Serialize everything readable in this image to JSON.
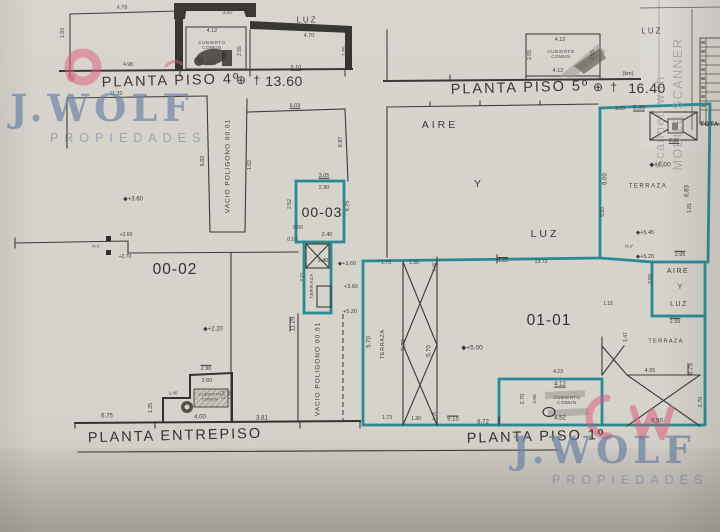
{
  "watermarks": {
    "brand": "J.WOLF",
    "sub": "PROPIEDADES",
    "scan_line1": "Scanned with",
    "scan_line2": "MOBILE SCANNER"
  },
  "plans": {
    "piso4": {
      "title": "PLANTA PISO 4º",
      "marker": "⊕ †",
      "level": "13.60"
    },
    "piso5": {
      "title": "PLANTA PISO 5º",
      "marker": "⊕ †",
      "level": "16.40"
    },
    "entrepiso": {
      "title": "PLANTA ENTREPISO"
    },
    "piso1": {
      "title": "PLANTA PISO 1º"
    }
  },
  "units": {
    "u02": "00-02",
    "u03": "00-03",
    "u11": "01-01"
  },
  "courtyard": {
    "aire": "AIRE",
    "y": "Y",
    "luz": "LUZ"
  },
  "table": {
    "total": "TOTA"
  },
  "colors": {
    "teal": "#2a8a94",
    "ink": "#3c3a34",
    "brand_blue": "#6d84a6",
    "pink": "#d95573",
    "paper": "#d6d3cc"
  },
  "labels": [
    {
      "t": "4.78",
      "x": 122,
      "y": 8,
      "r": -3,
      "s": 5.5
    },
    {
      "t": "1.93",
      "x": 64,
      "y": 33,
      "r": -90,
      "s": 5
    },
    {
      "t": "3.87",
      "x": 228,
      "y": 13,
      "r": -2,
      "s": 5.5
    },
    {
      "t": "4.12",
      "x": 212,
      "y": 31,
      "s": 5.5
    },
    {
      "t": "CUBIERTO COMUN",
      "x": 212,
      "y": 45,
      "wd": 34,
      "s": 4.5,
      "w": 0.5
    },
    {
      "t": "4.12",
      "x": 211,
      "y": 64,
      "s": 5.5
    },
    {
      "t": "2.55",
      "x": 182,
      "y": 51,
      "r": -90,
      "s": 5
    },
    {
      "t": "2.55",
      "x": 241,
      "y": 51,
      "r": -90,
      "s": 5
    },
    {
      "t": "4.98",
      "x": 128,
      "y": 66,
      "s": 5
    },
    {
      "t": "4.70",
      "x": 309,
      "y": 36,
      "s": 5.5
    },
    {
      "t": "6.10",
      "x": 296,
      "y": 68,
      "u": 1,
      "s": 5.5
    },
    {
      "t": "1.85",
      "x": 346,
      "y": 51,
      "r": -90,
      "s": 5
    },
    {
      "t": "LUZ",
      "x": 307,
      "y": 20,
      "s": 8,
      "w": 2
    },
    {
      "t": "4.12",
      "x": 560,
      "y": 40,
      "s": 5.5
    },
    {
      "t": "CUBIERTO COMUN",
      "x": 561,
      "y": 54,
      "wd": 34,
      "s": 4.5,
      "w": 0.5
    },
    {
      "t": "4.12",
      "x": 558,
      "y": 71,
      "s": 5.5
    },
    {
      "t": "2.55",
      "x": 531,
      "y": 55,
      "r": -90,
      "s": 5
    },
    {
      "t": "2.55",
      "x": 594,
      "y": 55,
      "r": -90,
      "s": 5
    },
    {
      "t": "LUZ",
      "x": 652,
      "y": 31,
      "s": 8,
      "w": 2
    },
    {
      "t": "(km)",
      "x": 628,
      "y": 74,
      "s": 5.5
    },
    {
      "t": "11.32",
      "x": 116,
      "y": 94,
      "s": 5.5
    },
    {
      "t": "6.03",
      "x": 295,
      "y": 106,
      "u": 1,
      "s": 5.5
    },
    {
      "t": "VACIO POLIGONO 00.01",
      "x": 228,
      "y": 166,
      "r": -90,
      "s": 6.5,
      "w": 1
    },
    {
      "t": "6.82",
      "x": 203,
      "y": 161,
      "r": -90,
      "s": 5.5
    },
    {
      "t": "1.62",
      "x": 251,
      "y": 165,
      "r": -90,
      "s": 5
    },
    {
      "t": "6.87",
      "x": 341,
      "y": 142,
      "r": -90,
      "s": 5.5
    },
    {
      "t": "3.05",
      "x": 324,
      "y": 176,
      "u": 1,
      "s": 5.5
    },
    {
      "t": "2.90",
      "x": 324,
      "y": 188,
      "s": 5.5
    },
    {
      "t": "2.52",
      "x": 291,
      "y": 204,
      "r": -90,
      "s": 5
    },
    {
      "t": "6.75",
      "x": 348,
      "y": 206,
      "r": -90,
      "s": 5.5
    },
    {
      "t": "0.50",
      "x": 298,
      "y": 229,
      "s": 5
    },
    {
      "t": "0.10",
      "x": 292,
      "y": 241,
      "s": 5
    },
    {
      "t": "2.40",
      "x": 327,
      "y": 235,
      "s": 5.5
    },
    {
      "t": "3.40",
      "x": 323,
      "y": 261,
      "s": 5.5
    },
    {
      "t": "◆+3.60",
      "x": 347,
      "y": 264,
      "s": 5.5
    },
    {
      "t": "TERRAZA",
      "x": 313,
      "y": 286,
      "r": -90,
      "s": 4.8,
      "w": 0.5
    },
    {
      "t": "2.21",
      "x": 303,
      "y": 277,
      "r": -90,
      "s": 4.8
    },
    {
      "t": "+3.60",
      "x": 351,
      "y": 287,
      "s": 5.5
    },
    {
      "t": "+5.20",
      "x": 350,
      "y": 312,
      "s": 5.5
    },
    {
      "t": "11.29",
      "x": 294,
      "y": 324,
      "r": -90,
      "o": 1,
      "s": 6
    },
    {
      "t": "VACIO POLIGONO 00.01",
      "x": 318,
      "y": 369,
      "r": -90,
      "s": 6.5,
      "w": 1
    },
    {
      "t": "◆+3.60",
      "x": 133,
      "y": 200,
      "s": 6
    },
    {
      "t": "N.V",
      "x": 96,
      "y": 246,
      "s": 4.5
    },
    {
      "t": "+3.60",
      "x": 126,
      "y": 236,
      "s": 5
    },
    {
      "t": "+2.70",
      "x": 125,
      "y": 258,
      "s": 5
    },
    {
      "t": "◆+2.20",
      "x": 213,
      "y": 330,
      "s": 6
    },
    {
      "t": "6.75",
      "x": 107,
      "y": 417,
      "s": 6
    },
    {
      "t": "1.35",
      "x": 152,
      "y": 408,
      "r": -90,
      "s": 5
    },
    {
      "t": "1.45",
      "x": 173,
      "y": 393,
      "s": 4.5
    },
    {
      "t": "2.90",
      "x": 206,
      "y": 369,
      "o": 1,
      "s": 5.5
    },
    {
      "t": "2.60",
      "x": 207,
      "y": 381,
      "s": 5.5
    },
    {
      "t": "CUBIERTO COMUN",
      "x": 210,
      "y": 397,
      "wd": 30,
      "s": 4,
      "w": 0.3
    },
    {
      "t": "4.00",
      "x": 200,
      "y": 418,
      "s": 6
    },
    {
      "t": "3.81",
      "x": 262,
      "y": 419,
      "s": 6
    },
    {
      "t": "2.54",
      "x": 223,
      "y": 395,
      "r": -90,
      "s": 4.5
    },
    {
      "t": "1.60",
      "x": 230,
      "y": 395,
      "r": -90,
      "s": 4.5
    },
    {
      "t": "1.73",
      "x": 386,
      "y": 264,
      "s": 5.2
    },
    {
      "t": "1.30",
      "x": 414,
      "y": 264,
      "s": 5.2
    },
    {
      "t": "0.95",
      "x": 434,
      "y": 267,
      "r": -90,
      "s": 4.5
    },
    {
      "t": "1.22",
      "x": 503,
      "y": 262,
      "o": 1,
      "s": 5.2
    },
    {
      "t": "13.72",
      "x": 541,
      "y": 263,
      "s": 5.2
    },
    {
      "t": "5.70",
      "x": 370,
      "y": 342,
      "r": -90,
      "s": 6
    },
    {
      "t": "TERRAZA",
      "x": 384,
      "y": 344,
      "r": -90,
      "s": 5.2,
      "w": 0.8
    },
    {
      "t": "5.70",
      "x": 405,
      "y": 345,
      "r": -90,
      "s": 6
    },
    {
      "t": "5.70",
      "x": 430,
      "y": 351,
      "r": -90,
      "s": 6
    },
    {
      "t": "◆+5.00",
      "x": 472,
      "y": 348,
      "s": 6.5
    },
    {
      "t": "1.73",
      "x": 387,
      "y": 419,
      "s": 5.2
    },
    {
      "t": "1.30",
      "x": 416,
      "y": 420,
      "s": 5.2
    },
    {
      "t": "0.95",
      "x": 434,
      "y": 416,
      "r": -90,
      "s": 4.5
    },
    {
      "t": "9.15",
      "x": 453,
      "y": 420,
      "o": 1,
      "s": 6
    },
    {
      "t": "8.72",
      "x": 483,
      "y": 423,
      "s": 6
    },
    {
      "t": "4.23",
      "x": 558,
      "y": 373,
      "s": 5
    },
    {
      "t": "4.12",
      "x": 560,
      "y": 385,
      "u": 1,
      "s": 6
    },
    {
      "t": "CUBIERTO COMUN",
      "x": 567,
      "y": 400,
      "wd": 42,
      "s": 4.5,
      "w": 0.5
    },
    {
      "t": "4.52",
      "x": 560,
      "y": 419,
      "s": 6
    },
    {
      "t": "2.70",
      "x": 523,
      "y": 399,
      "r": -90,
      "s": 5.5
    },
    {
      "t": "2.55",
      "x": 536,
      "y": 399,
      "r": -90,
      "s": 4.8
    },
    {
      "t": "3.29",
      "x": 620,
      "y": 110,
      "s": 5
    },
    {
      "t": "5.35",
      "x": 639,
      "y": 109,
      "u": 1,
      "s": 6
    },
    {
      "t": "3.30",
      "x": 674,
      "y": 141,
      "u": 1,
      "s": 5.5
    },
    {
      "t": "◆+6.00",
      "x": 660,
      "y": 165,
      "s": 6.5
    },
    {
      "t": "TERRAZA",
      "x": 648,
      "y": 187,
      "s": 6,
      "w": 1.5
    },
    {
      "t": "6.00",
      "x": 606,
      "y": 179,
      "r": -90,
      "s": 6
    },
    {
      "t": "5.93",
      "x": 604,
      "y": 212,
      "r": -90,
      "s": 5
    },
    {
      "t": "6.83",
      "x": 688,
      "y": 191,
      "r": -90,
      "s": 6
    },
    {
      "t": "1.81",
      "x": 691,
      "y": 208,
      "r": -90,
      "s": 5
    },
    {
      "t": "◆+5.45",
      "x": 645,
      "y": 233,
      "s": 5.5
    },
    {
      "t": "N.V",
      "x": 629,
      "y": 246,
      "s": 4.5
    },
    {
      "t": "◆+5.20",
      "x": 645,
      "y": 257,
      "s": 5.5
    },
    {
      "t": "2.95",
      "x": 680,
      "y": 255,
      "o": 1,
      "s": 5.5
    },
    {
      "t": "1.15",
      "x": 608,
      "y": 305,
      "s": 5
    },
    {
      "t": "AIRE",
      "x": 678,
      "y": 272,
      "s": 7,
      "w": 1.5
    },
    {
      "t": "Y",
      "x": 680,
      "y": 288,
      "s": 7
    },
    {
      "t": "LUZ",
      "x": 679,
      "y": 305,
      "s": 7,
      "w": 1.5
    },
    {
      "t": "3.59",
      "x": 652,
      "y": 279,
      "r": -90,
      "s": 5
    },
    {
      "t": "2.55",
      "x": 675,
      "y": 322,
      "o": 1,
      "s": 5.5
    },
    {
      "t": "1.47",
      "x": 627,
      "y": 337,
      "r": -90,
      "s": 5
    },
    {
      "t": "TERRAZA",
      "x": 666,
      "y": 342,
      "s": 5.8,
      "w": 1.2
    },
    {
      "t": "4.55",
      "x": 650,
      "y": 371,
      "s": 5.5
    },
    {
      "t": "6.75",
      "x": 692,
      "y": 369,
      "r": -90,
      "o": 1,
      "s": 6
    },
    {
      "t": "2.70",
      "x": 701,
      "y": 402,
      "r": -90,
      "s": 5.5
    },
    {
      "t": "6.50",
      "x": 657,
      "y": 422,
      "s": 6
    }
  ]
}
